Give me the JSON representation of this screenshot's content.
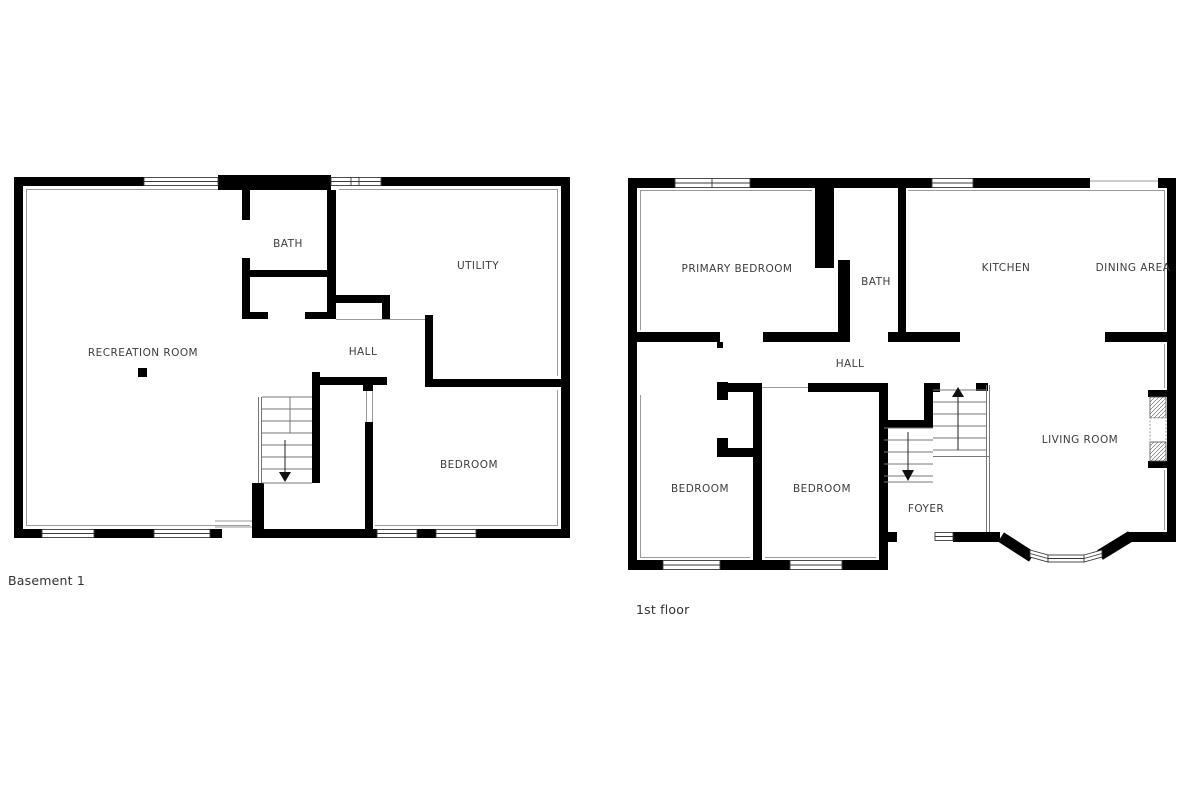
{
  "document": {
    "type": "floor-plan-sheet",
    "background_color": "#ffffff",
    "wall_color": "#000000",
    "thin_line_color": "#9a9a9a",
    "label_color": "#3d3d3d"
  },
  "plans": {
    "basement": {
      "caption": "Basement 1",
      "rooms": {
        "recreation": "RECREATION ROOM",
        "bath": "BATH",
        "utility": "UTILITY",
        "hall": "HALL",
        "bedroom": "BEDROOM"
      },
      "features": {
        "stairs_direction": "down"
      }
    },
    "first_floor": {
      "caption": "1st floor",
      "rooms": {
        "primary_bedroom": "PRIMARY BEDROOM",
        "bath": "BATH",
        "kitchen": "KITCHEN",
        "dining": "DINING AREA",
        "hall": "HALL",
        "bedroom_left": "BEDROOM",
        "bedroom_middle": "BEDROOM",
        "foyer": "FOYER",
        "living_room": "LIVING ROOM"
      },
      "features": {
        "stairs_up_direction": "up",
        "stairs_down_direction": "down",
        "bay_window": true,
        "fireplace": true
      }
    }
  }
}
